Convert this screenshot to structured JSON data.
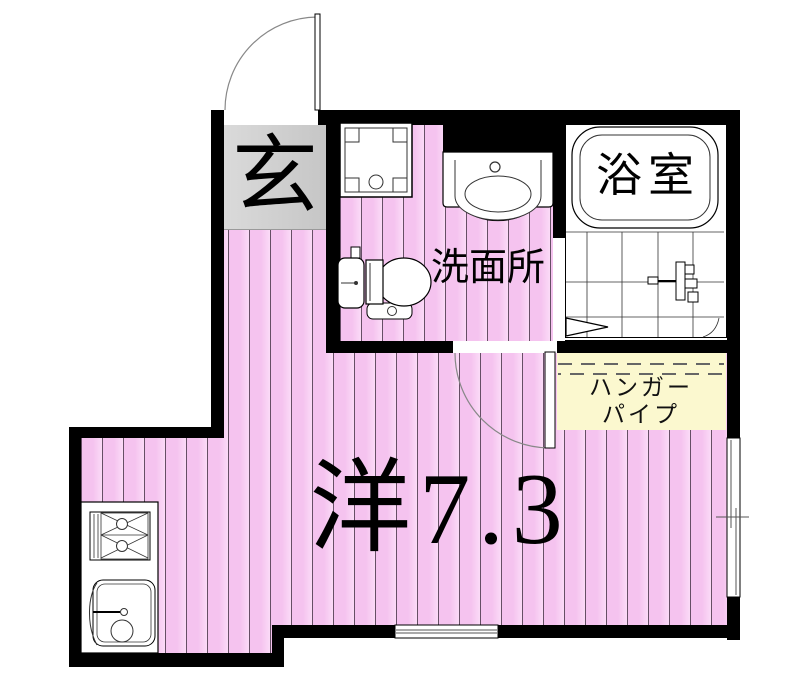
{
  "page": {
    "type": "apartment-floor-plan"
  },
  "labels": {
    "entrance": "玄",
    "washroom": "洗面所",
    "bathroom": "浴室",
    "main_room": "洋7.3",
    "hanger_pipe_line1": "ハンガー",
    "hanger_pipe_line2": "パイプ"
  },
  "colors": {
    "wall": "#000000",
    "floor-pink": "#f7c8f2",
    "floor-stripe": "#64506a",
    "genkan-gray": "#c6c6c6",
    "hanger-yellow": "#fbf8cf",
    "label-text": "#000000"
  }
}
